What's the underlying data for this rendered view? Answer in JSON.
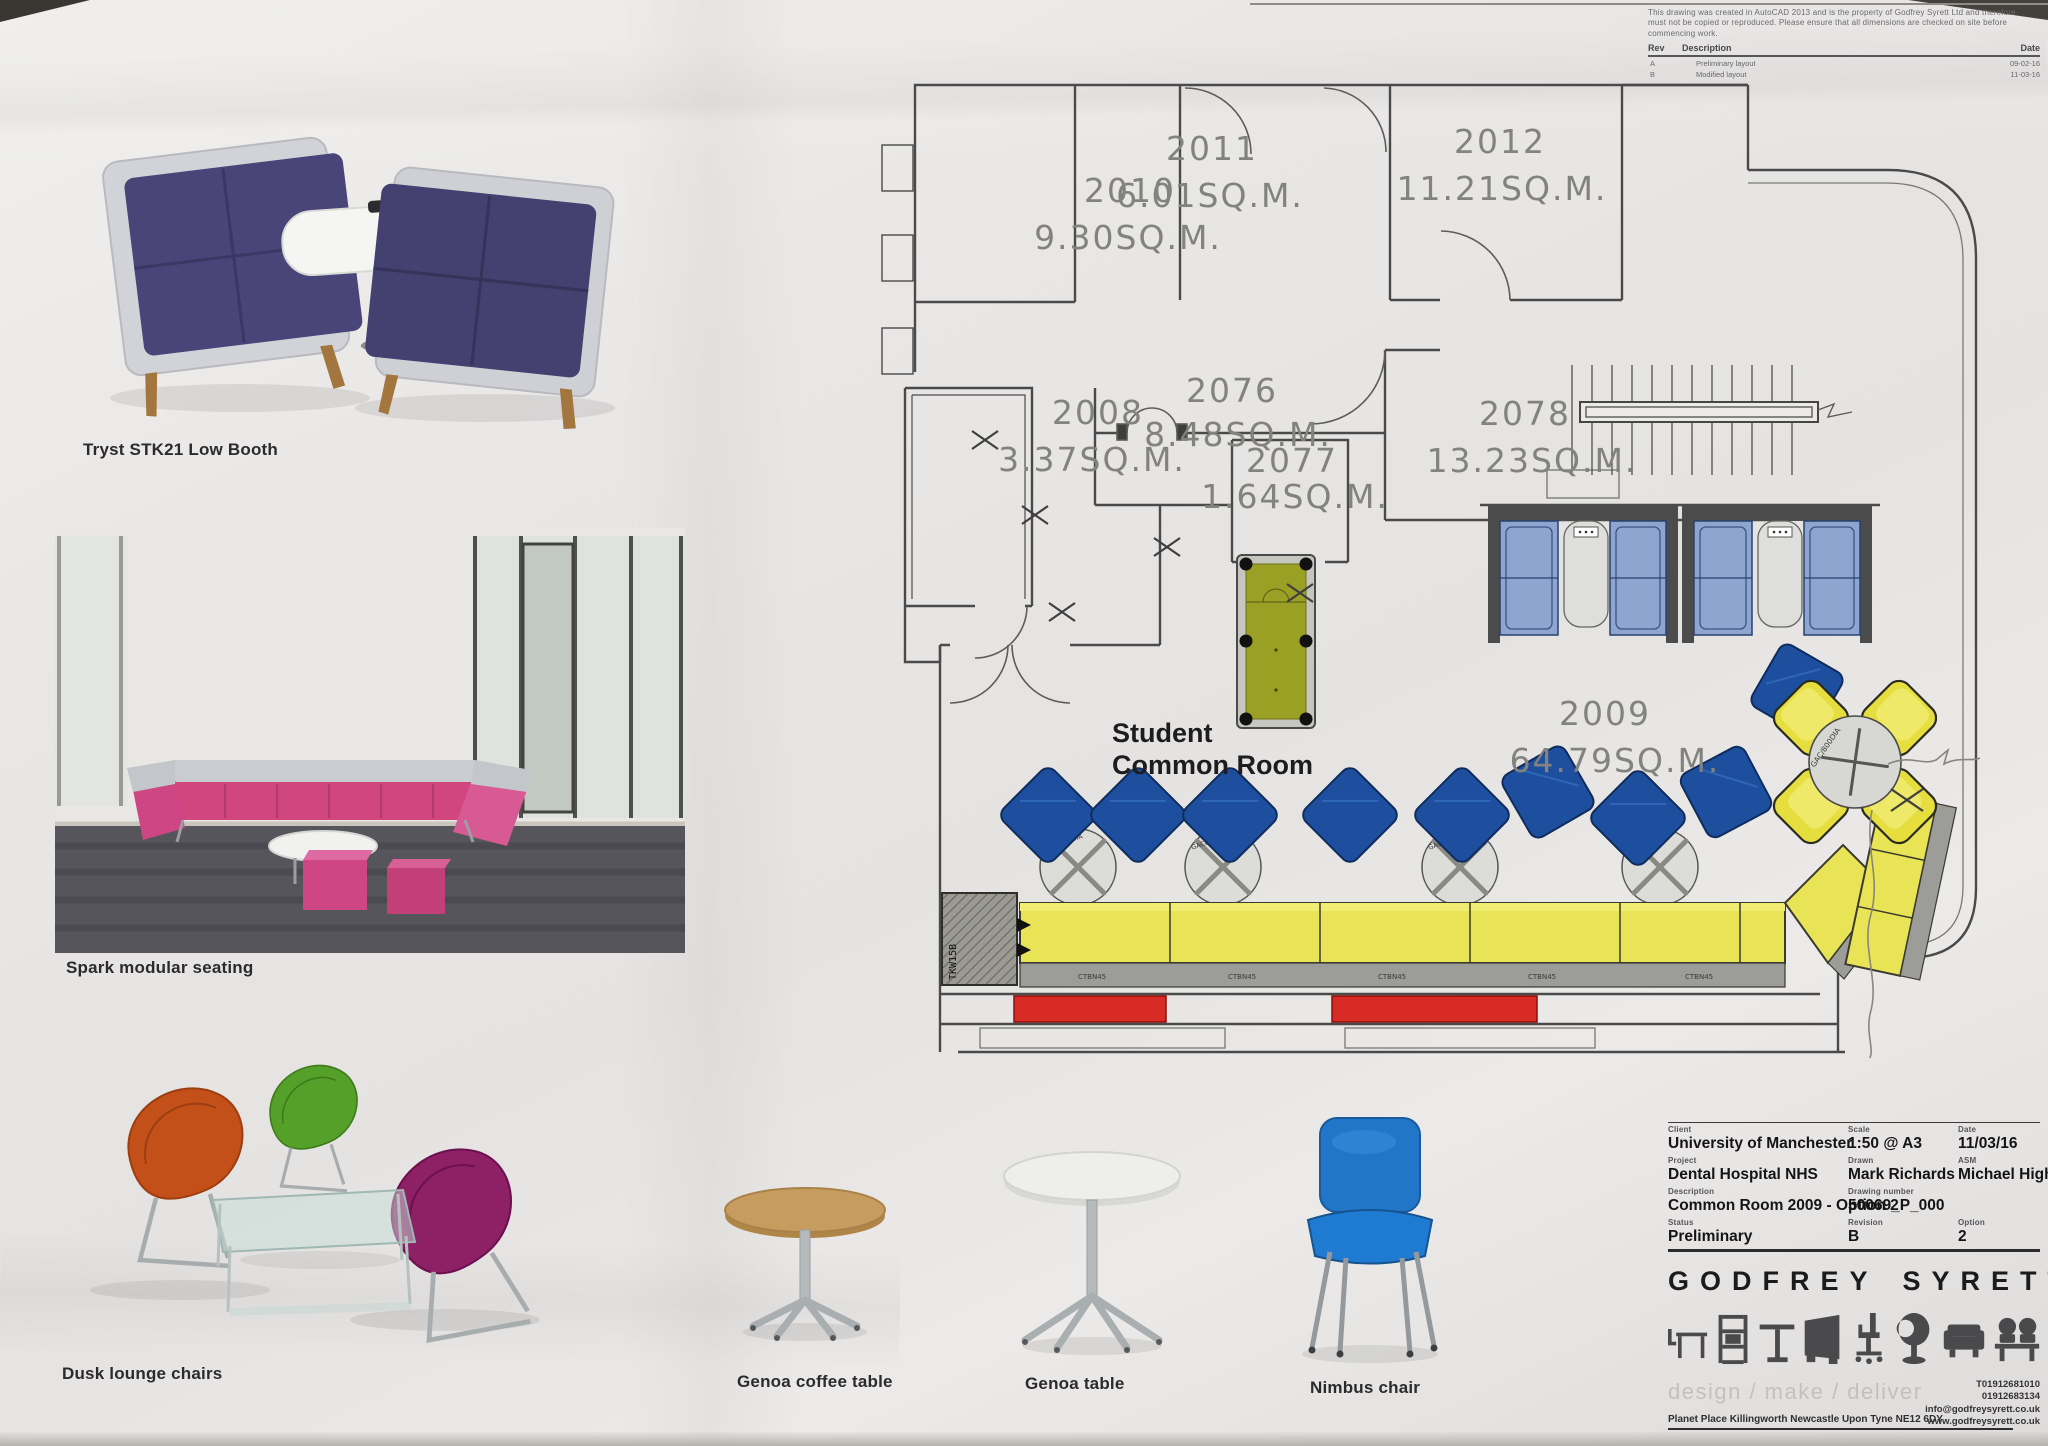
{
  "notes": {
    "disclaimer_lines": [
      "This drawing was created in AutoCAD 2013 and is the property of Godfrey Syrett Ltd and therefore",
      "must not be copied or reproduced. Please ensure that all dimensions are checked on site before",
      "commencing work."
    ],
    "rev_header": "Rev",
    "desc_header": "Description",
    "date_header": "Date",
    "revisions": [
      {
        "rev": "A",
        "description": "Preliminary layout",
        "date": "09-02-16"
      },
      {
        "rev": "B",
        "description": "Modified layout",
        "date": "11-03-16"
      }
    ]
  },
  "plan": {
    "rooms": [
      {
        "number": "2010",
        "area": "9.30SQ.M."
      },
      {
        "number": "2011",
        "area": "6.01SQ.M."
      },
      {
        "number": "2012",
        "area": "11.21SQ.M."
      },
      {
        "number": "2008",
        "area": "3.37SQ.M."
      },
      {
        "number": "2076",
        "area": "8.48SQ.M."
      },
      {
        "number": "2077",
        "area": "1.64SQ.M."
      },
      {
        "number": "2078",
        "area": "13.23SQ.M."
      },
      {
        "number": "2009",
        "area": "64.79SQ.M."
      }
    ],
    "common_room_line1": "Student",
    "common_room_line2": "Common Room",
    "codes": {
      "wall_unit": "TKW15B",
      "table_800": "GAC/800DIA",
      "coffee_table": "GAC600DIA",
      "bench": "CTBN45"
    }
  },
  "products": {
    "tryst": "Tryst STK21 Low Booth",
    "spark": "Spark modular seating",
    "dusk": "Dusk lounge chairs",
    "genoa_coffee": "Genoa coffee table",
    "genoa": "Genoa table",
    "nimbus": "Nimbus chair"
  },
  "title_block": {
    "client_label": "Client",
    "client": "University of Manchester",
    "scale_label": "Scale",
    "scale": "1:50 @ A3",
    "date_label": "Date",
    "date": "11/03/16",
    "project_label": "Project",
    "project": "Dental Hospital NHS",
    "drawn_label": "Drawn",
    "drawn": "Mark Richards",
    "asm_label": "ASM",
    "asm": "Michael Higham",
    "description_label": "Description",
    "description": "Common Room 2009 - Option 2",
    "drawing_number_label": "Drawing number",
    "drawing_number": "50069_P_000",
    "status_label": "Status",
    "status": "Preliminary",
    "revision_label": "Revision",
    "revision": "B",
    "option_label": "Option",
    "option": "2",
    "logo": "GODFREY SYRETT",
    "tagline": "design / make / deliver",
    "address": "Planet Place Killingworth Newcastle Upon Tyne NE12 6DY",
    "contact_lines": [
      "T01912681010",
      "01912683134",
      "info@godfreysyrett.co.uk",
      "www.godfreysyrett.co.uk"
    ]
  },
  "colors": {
    "plan_chair_blue": "#1d4f9e",
    "plan_sofa_blue": "#8ea6cf",
    "plan_bench_yellow": "#e9e455",
    "plan_pool_green": "#99a024",
    "plan_radiator_red": "#d92b25",
    "spark_pink": "#d1467f",
    "dusk_orange": "#c35018",
    "dusk_green": "#55a028",
    "dusk_purple": "#8e2166",
    "nimbus_blue": "#2176c9"
  }
}
